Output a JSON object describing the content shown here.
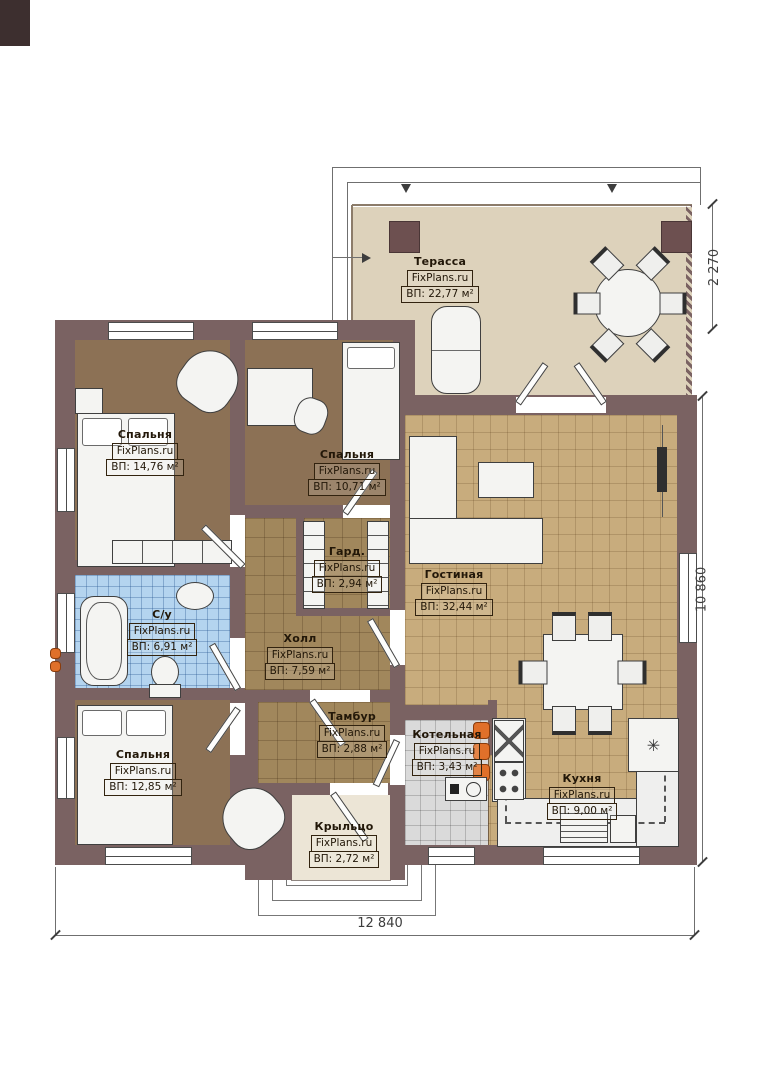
{
  "brand": "FixPlans.ru",
  "rooms": {
    "terrace": {
      "name": "Терасса",
      "area": "ВП: 22,77 м²"
    },
    "bedroom1": {
      "name": "Спальня",
      "area": "ВП: 14,76 м²"
    },
    "bedroom2": {
      "name": "Спальня",
      "area": "ВП: 10,71 м²"
    },
    "wardrobe": {
      "name": "Гард.",
      "area": "ВП: 2,94 м²"
    },
    "bathroom": {
      "name": "С/у",
      "area": "ВП: 6,91 м²"
    },
    "hall": {
      "name": "Холл",
      "area": "ВП: 7,59 м²"
    },
    "living": {
      "name": "Гостиная",
      "area": "ВП: 32,44 м²"
    },
    "bedroom3": {
      "name": "Спальня",
      "area": "ВП: 12,85 м²"
    },
    "vestibule": {
      "name": "Тамбур",
      "area": "ВП: 2,88 м²"
    },
    "boiler": {
      "name": "Котельная",
      "area": "ВП: 3,43 м²"
    },
    "kitchen": {
      "name": "Кухня",
      "area": "ВП: 9,00 м²"
    },
    "porch": {
      "name": "Крыльцо",
      "area": "ВП: 2,72 м²"
    }
  },
  "dimensions": {
    "terrace_depth": "2 270",
    "house_depth": "10 860",
    "house_width": "12 840"
  },
  "icons": {
    "fridge_symbol": "✳"
  },
  "colors": {
    "wall": "#7a6262",
    "tile_tan": "#c8ac7d",
    "tile_brown": "#a1875c",
    "bedroom_floor": "#8c7155",
    "bathroom_tile": "#b4d4ef",
    "terrace_floor": "#ddd2bb",
    "accent_orange": "#e0702a"
  }
}
